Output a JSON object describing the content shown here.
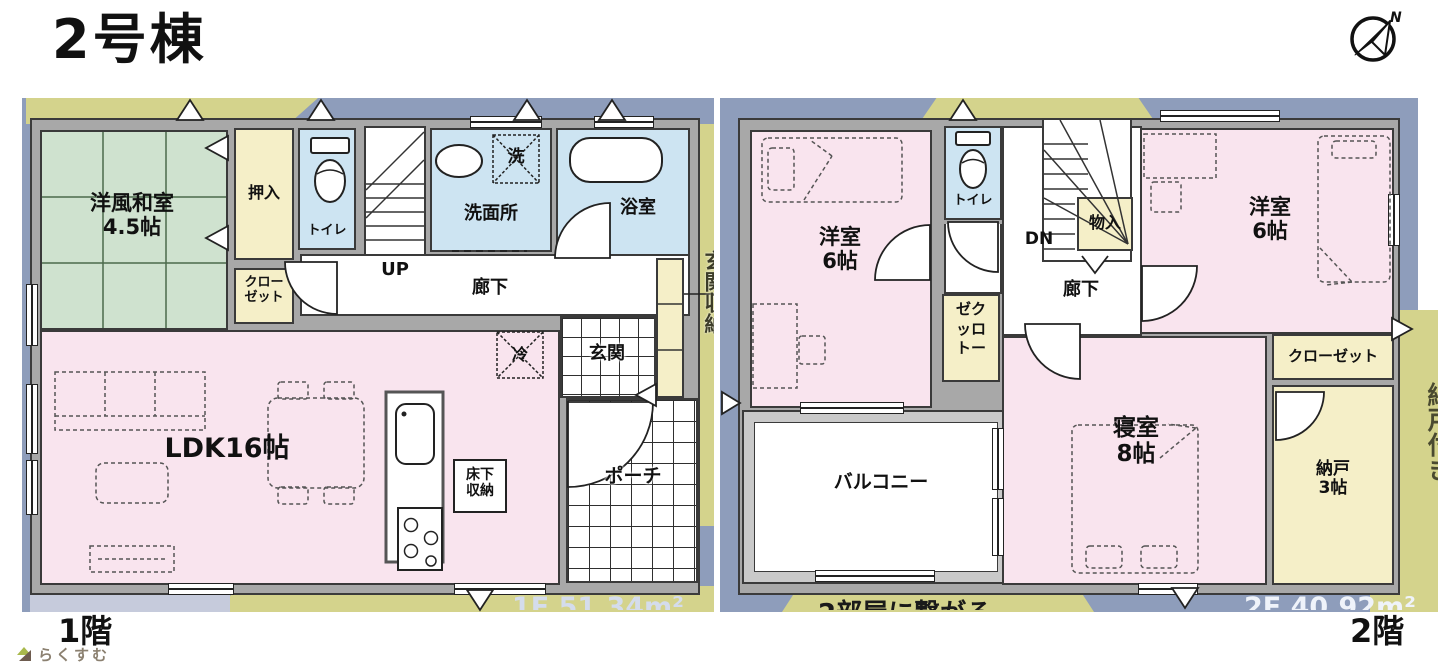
{
  "header": {
    "title": "2号棟",
    "compass_n": "N"
  },
  "floor1": {
    "label": "1階",
    "area_partial": "1F 51.34m²",
    "rooms": {
      "washitsu": {
        "name": "洋風和室",
        "size": "4.5帖"
      },
      "oshiire": "押入",
      "closet": [
        "クロー",
        "ゼット"
      ],
      "toilet": "トイレ",
      "stairs_up": "UP",
      "senmenjo": "洗面所",
      "washer": "洗",
      "bath": "浴室",
      "hall": "廊下",
      "fridge": "冷",
      "genkan": "玄関",
      "genkan_storage": "玄関収納",
      "ldk": "LDK16帖",
      "yukashita": [
        "床下",
        "収納"
      ],
      "porch": "ポーチ"
    }
  },
  "floor2": {
    "label": "2階",
    "area_partial": "2F 40.92m²",
    "note_partial": "2部屋に繋がる",
    "rooms": {
      "yoshitsu_left": {
        "name": "洋室",
        "size": "6帖"
      },
      "toilet": "トイレ",
      "stairs_down": "DN",
      "monoire": "物入",
      "hall": "廊下",
      "closet_vertical": [
        "ゼク",
        "ッロ",
        "トー"
      ],
      "yoshitsu_right": {
        "name": "洋室",
        "size": "6帖"
      },
      "closet": "クローゼット",
      "shinshitsu": {
        "name": "寝室",
        "size": "8帖"
      },
      "balcony": "バルコニー",
      "nando": {
        "name": "納戸",
        "size": "3帖"
      },
      "nando_tsuki": "納戸付き"
    }
  },
  "footer": {
    "logo": "らくすむ"
  },
  "colors": {
    "wall": "#a8a8a8",
    "band_blue": "#8e9dbb",
    "band_olive": "#d4d38c",
    "room_pink": "#f9e4ee",
    "room_green": "#cfe2cf",
    "room_cream": "#f5efc8",
    "room_blue": "#cde4f2"
  }
}
